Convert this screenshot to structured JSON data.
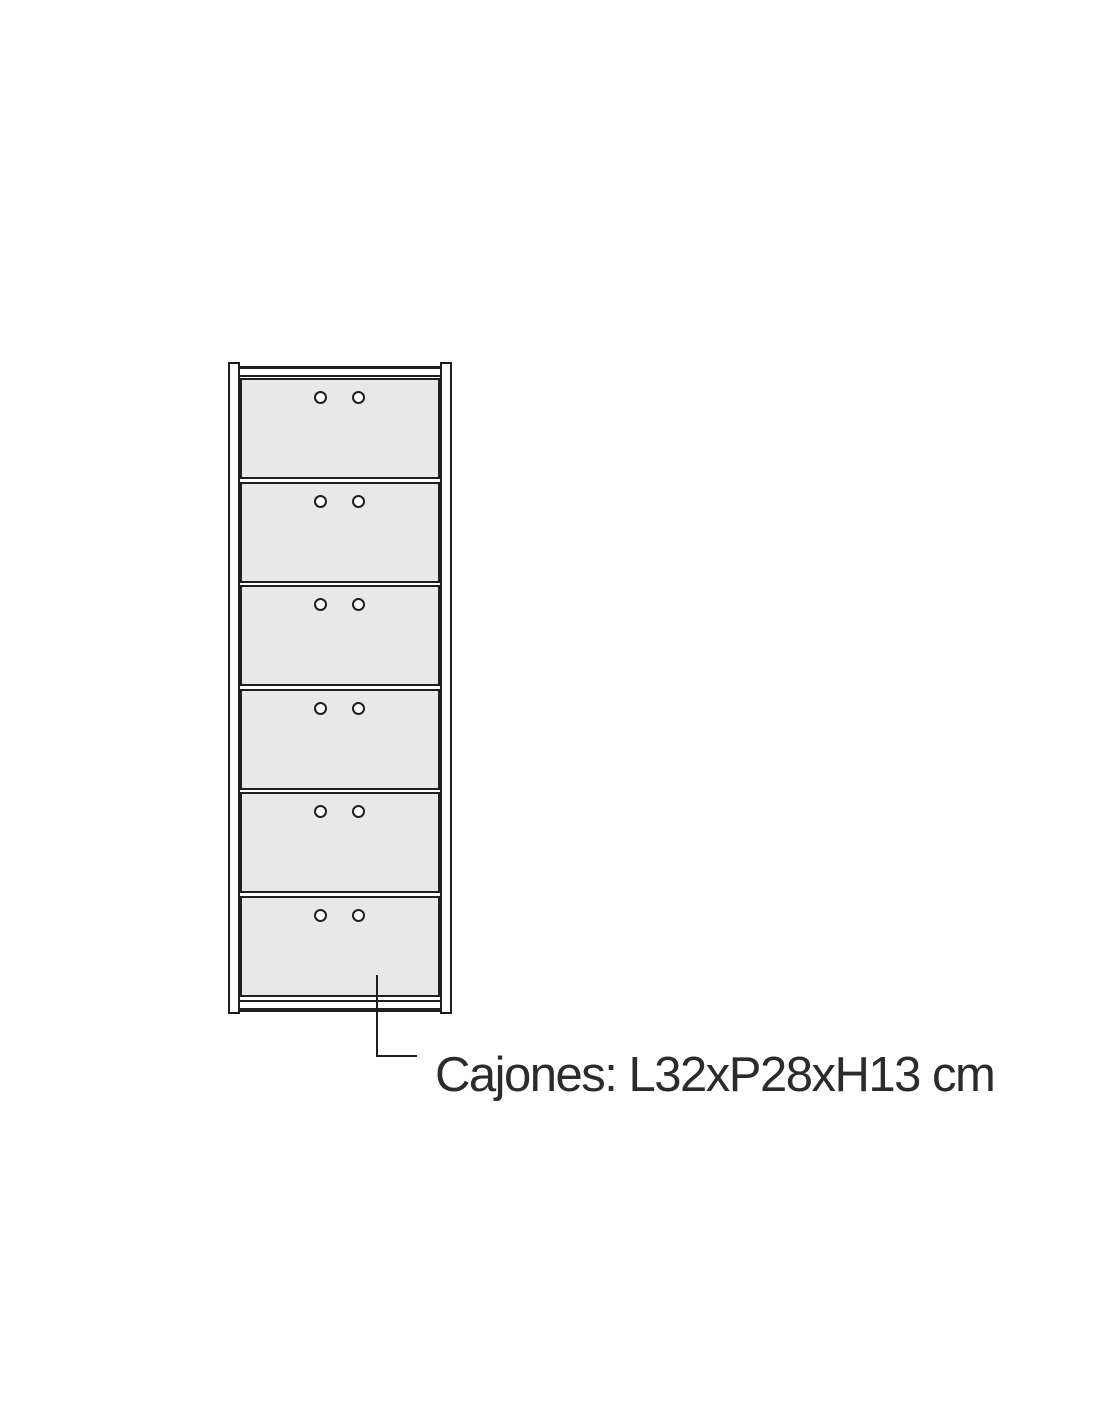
{
  "page": {
    "background": "#ffffff"
  },
  "diagram": {
    "type": "furniture-front-elevation-diagram",
    "cabinet": {
      "drawer_count": 6,
      "knobs_per_drawer": 2
    },
    "colors": {
      "stroke": "#1f1f1f",
      "drawer_fill": "#e8e8e8",
      "surface": "#ffffff",
      "text": "#2b2b2b"
    },
    "callout": {
      "label": "Cajones: L32xP28xH13 cm"
    }
  }
}
